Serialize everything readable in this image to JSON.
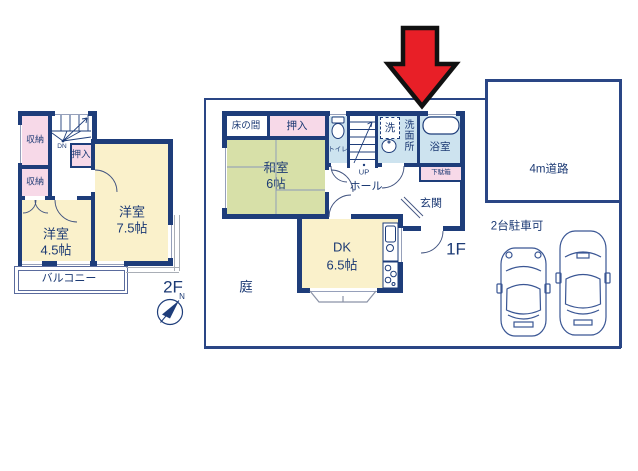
{
  "floor2": {
    "floor_label": "2F",
    "closet_top": "収納",
    "closet_bottom": "収納",
    "oshiire": "押入",
    "stairs_down": "DN",
    "room_large_name": "洋室",
    "room_large_size": "7.5帖",
    "room_small_name": "洋室",
    "room_small_size": "4.5帖",
    "balcony": "バルコニー"
  },
  "floor1": {
    "floor_label": "1F",
    "tokonoma": "床の間",
    "oshiire": "押入",
    "washitsu_name": "和室",
    "washitsu_size": "6帖",
    "toilet": "トイレ",
    "laundry": "洗",
    "washroom": "洗面所",
    "bathroom": "浴室",
    "stairs_up": "UP",
    "hall": "ホール",
    "shoe_cabinet": "下駄箱",
    "entrance": "玄関",
    "dk_name": "DK",
    "dk_size": "6.5帖",
    "garden": "庭"
  },
  "site": {
    "road": "4m道路",
    "parking": "2台駐車可"
  },
  "compass": {
    "north_label": "N"
  },
  "colors": {
    "wall_navy": "#1e3d7a",
    "lot_line": "#2a4685",
    "room_yellow": "#faf1cb",
    "tatami_green": "#d7e0a8",
    "closet_pink": "#f7d9e8",
    "wet_area_blue": "#cde3ef",
    "text_navy": "#1c3a74",
    "arrow_red": "#e81f27",
    "arrow_outline": "#111111"
  }
}
